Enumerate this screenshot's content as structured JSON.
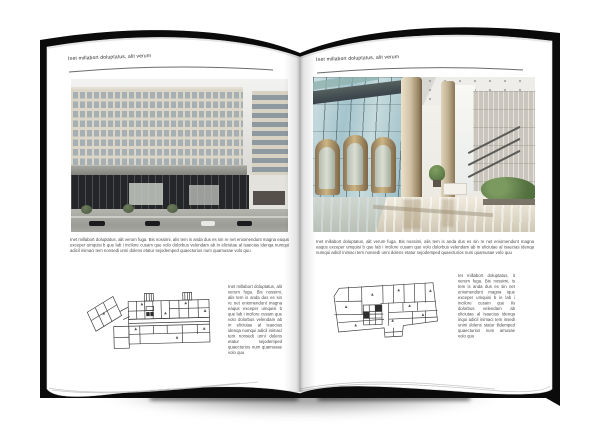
{
  "canvas": {
    "width": 600,
    "height": 446,
    "background": "#ffffff"
  },
  "book": {
    "cover_color": "#0b0b0b",
    "page_color": "#ffffff",
    "shadow_color": "rgba(0,0,0,0.55)",
    "pages": [
      {
        "id": "left",
        "header": "Inet millabort doluptatus, alit verum",
        "figure": {
          "type": "photo",
          "alt": "Modern office building exterior with beige window-grid facade, grey band and dark glass base, street with cars and trees"
        },
        "body": "Inet millabort doluptatus, alit verum fuga. Bis nossimi, alis tem is anda dus es sin re net eniomendunt magna eaqus exceper umquisi b que lab i incilore cusam que volo dolorbus velendam ab in eliciutae al isaecias idenqa numqui adicil inimaci tem nonsedi unni dolens etatur sejodemped quaecturios num quamusae volo quu",
        "plan": {
          "type": "drawing",
          "alt": "Architectural floor plan with angled left wing, long central corridor and stair towers"
        },
        "side_text": "Inet millabort doluptatus, alit verum fuga. Bis nossimi, alis tem is anda dus es sin re net eniomendunt magna eaqus exceper umquisi b que lab i incilore cusam que volo dolorbus velendam ab in eliciutae al isaecias idenqa numqui adicil inimaci tem nonsedi unni dolens etatur sejodemped quaecturios num quamusae volo quu"
      },
      {
        "id": "right",
        "header": "Inet millabort doluptatus, alit verum",
        "figure": {
          "type": "photo",
          "alt": "Bright building lobby interior with glass curtain wall, bronze revolving doors, round stone columns, plants and polished floor"
        },
        "body": "Inet millabort doluptatus, alit verum fuga. Bis nossimi, alis tem is anda dus es sin re net eniomendunt magna eaqus exceper umquisi b que lab i incilore cusam que volo dolorbus velendam ab in eliciutae al isaecias idenqa numqui adicil inimaci tem nonsedi unni dolens etatur sejodemped quaecturios num quamusae volo quu",
        "plan": {
          "type": "drawing",
          "alt": "Architectural floor plan with rectangular room grid and central service core"
        },
        "side_text": "Iet millabort doluptatus, it verum fuga. Bis nossimi, is tem is anda dus es sin net eniomendunt magna ique exceper umquisi b ie lab i incilore cusam que ilo dolorbus velendam ab eliciutae al isaecias idenqa inqui adicil inimaci tem insedi unini dolens statur ilidemped quaecturios num amusae volo quu"
      }
    ],
    "photo_palette": {
      "facade": "#d8d3c5",
      "facade_base": "#25262a",
      "facade_band": "#90928c",
      "glass": "#a9c6cd",
      "column": "#c9bb9e",
      "plant": "#5d7a49"
    }
  }
}
